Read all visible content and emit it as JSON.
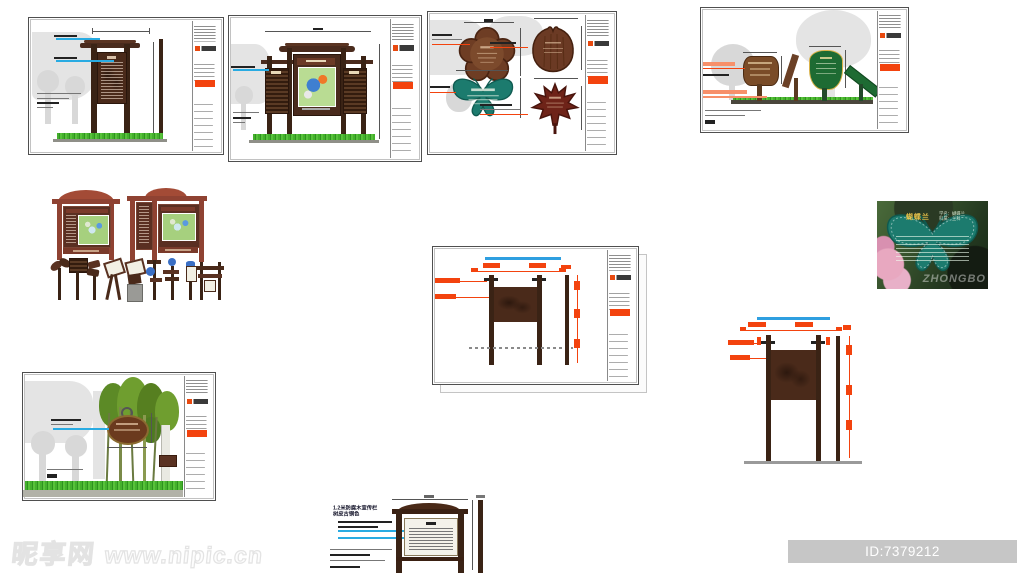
{
  "page": {
    "background": "#ffffff"
  },
  "site_watermark": {
    "logo": "昵享网",
    "url": "www.nipic.cn"
  },
  "id_bar": {
    "text": "ID:7379212 NO:20150410125727511000"
  },
  "photo_card": {
    "title": "蝴蝶兰",
    "meta_line1": "学名：蝴蝶兰",
    "meta_line2": "科属：兰科",
    "brand_watermark": "ZHONGBO"
  },
  "notes": {
    "line1": "1.2米防腐木宣传栏",
    "line2": "树皮古铜色"
  },
  "colors": {
    "accent_orange": "#f3430e",
    "leader_cyan": "#29abe2",
    "teal_sign": "#1c7b6e",
    "wood_dark": "#4a2a1a",
    "wood_red": "#a34b36",
    "green_sign": "#1e6b33",
    "maple_maroon": "#7a2a20",
    "grass_green": "#3fae2a",
    "idbar_gray": "#c6c6c6"
  }
}
